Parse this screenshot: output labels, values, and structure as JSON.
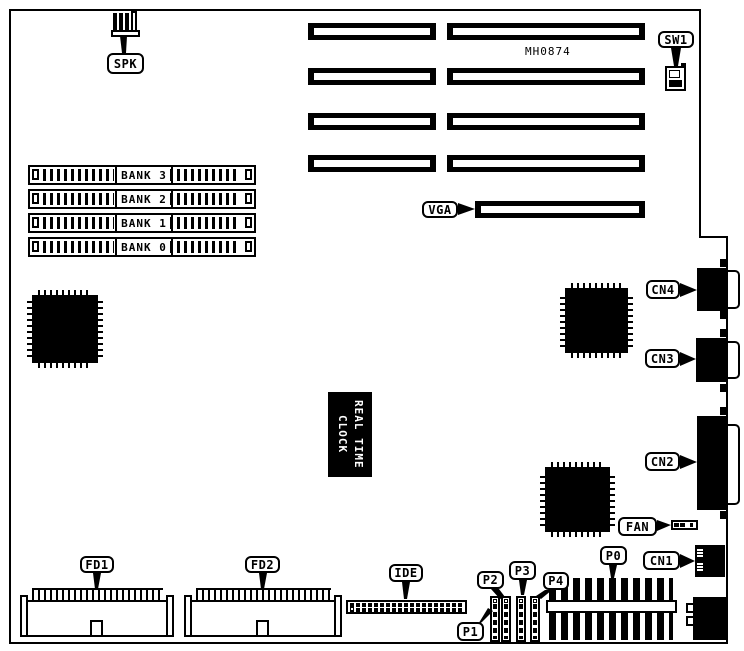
{
  "diagram": {
    "part_number": "MH0874",
    "colors": {
      "ink": "#000000",
      "paper": "#ffffff"
    },
    "callouts": {
      "spk": "SPK",
      "sw1": "SW1",
      "vga": "VGA",
      "cn4": "CN4",
      "cn3": "CN3",
      "cn2": "CN2",
      "cn1": "CN1",
      "fan": "FAN",
      "p0": "P0",
      "p1": "P1",
      "p2": "P2",
      "p3": "P3",
      "p4": "P4",
      "fd1": "FD1",
      "fd2": "FD2",
      "ide": "IDE"
    },
    "memory_banks": [
      "BANK 3",
      "BANK 2",
      "BANK 1",
      "BANK 0"
    ],
    "rtc": {
      "line1": "REAL TIME",
      "line2": "CLOCK"
    }
  }
}
